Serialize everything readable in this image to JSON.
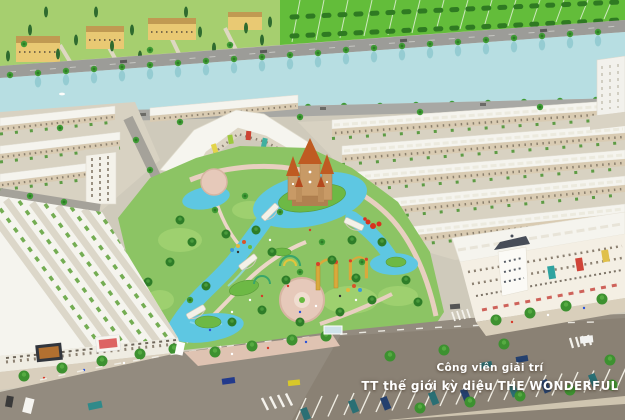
{
  "image": {
    "type": "aerial-masterplan-render",
    "caption_line1": "Công viên giải trí",
    "caption_line2": "TT thế giới kỳ diệu THE WONDERFUL"
  },
  "scene": {
    "landmarks": [
      "canal",
      "villas",
      "townhouse-rows",
      "theme-park",
      "castle",
      "lagoon",
      "golden-gates",
      "shophouses",
      "parking-lot"
    ]
  },
  "palette": {
    "canal_water": "#b7dee2",
    "lagoon_water": "#5ec7e2",
    "grass_bright": "#63bd3a",
    "park_green": "#8cc464",
    "roof_white": "#f5f4ee",
    "facade_tan": "#d9cbb2",
    "asphalt": "#938b7f",
    "parking_asphalt": "#8a8174",
    "path_pink": "#dfc3b2",
    "castle_wall": "#c89a66",
    "castle_roof": "#bf5b22",
    "villa_yellow": "#e9c973",
    "gold_gate": "#d9a93c",
    "caption_color": "#ffffff"
  }
}
